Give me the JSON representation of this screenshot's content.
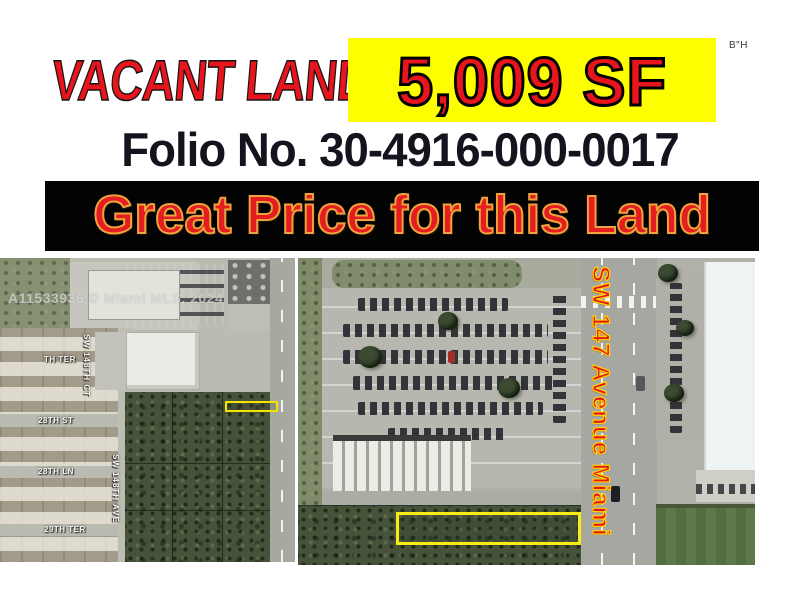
{
  "header": {
    "bh_mark": "B\"H",
    "title": "VACANT LAND",
    "size_label": "5,009 SF",
    "folio": "Folio No. 30-4916-000-0017",
    "banner": "Great Price for this Land"
  },
  "watermark": "A11533936 © Miami MLS, 2024",
  "left_map": {
    "labels": [
      {
        "text": "TH TER"
      },
      {
        "text": "SW 148TH CT"
      },
      {
        "text": "28TH ST"
      },
      {
        "text": "28TH LN"
      },
      {
        "text": "SW 148TH AVE"
      },
      {
        "text": "29TH TER"
      }
    ]
  },
  "right_map": {
    "avenue_label": "SW 147 Avenue Miami"
  },
  "colors": {
    "title_red": "#e8151c",
    "highlight_yellow": "#fdff00",
    "banner_bg": "#030303",
    "banner_outline": "#eda43c",
    "folio_text": "#14141e",
    "parcel_outline": "#f7ec13",
    "street_label": "#f7f7f2",
    "avenue_red": "#e8141c",
    "avenue_outline": "#ffd400"
  }
}
